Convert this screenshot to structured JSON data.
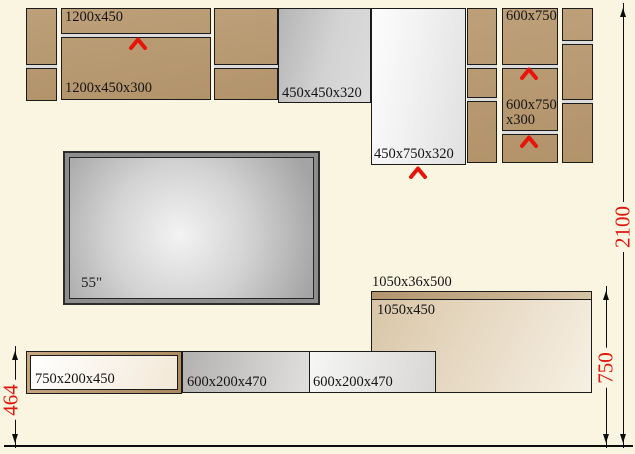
{
  "colors": {
    "background": "#faf5e1",
    "cabinet_wood": "#b7986f",
    "accent_red": "#df170e",
    "outline": "#1b1b1b"
  },
  "upper_cabinets": {
    "shelf_1200": {
      "top_label": "1200x450",
      "bottom_label": "1200x450x300"
    },
    "cabinet_450_450": {
      "label": "450x450x320"
    },
    "cabinet_450_750": {
      "label": "450x750x320"
    },
    "column_600": {
      "top_label": "600x750",
      "mid_label_line1": "600x750",
      "mid_label_line2": "x300"
    }
  },
  "tv": {
    "label": "55\""
  },
  "lower_units": {
    "shelf_750": {
      "label": "750x200x450"
    },
    "shelf_600_a": {
      "label": "600x200x470"
    },
    "shelf_600_b": {
      "label": "600x200x470"
    },
    "countertop": {
      "label": "1050x36x500"
    },
    "cabinet_1050": {
      "label": "1050x450"
    }
  },
  "dimensions": {
    "overall_height": "2100",
    "lower_right_height": "750",
    "lower_left_height": "464"
  },
  "icons": {
    "door_opening": "chevron-up"
  }
}
